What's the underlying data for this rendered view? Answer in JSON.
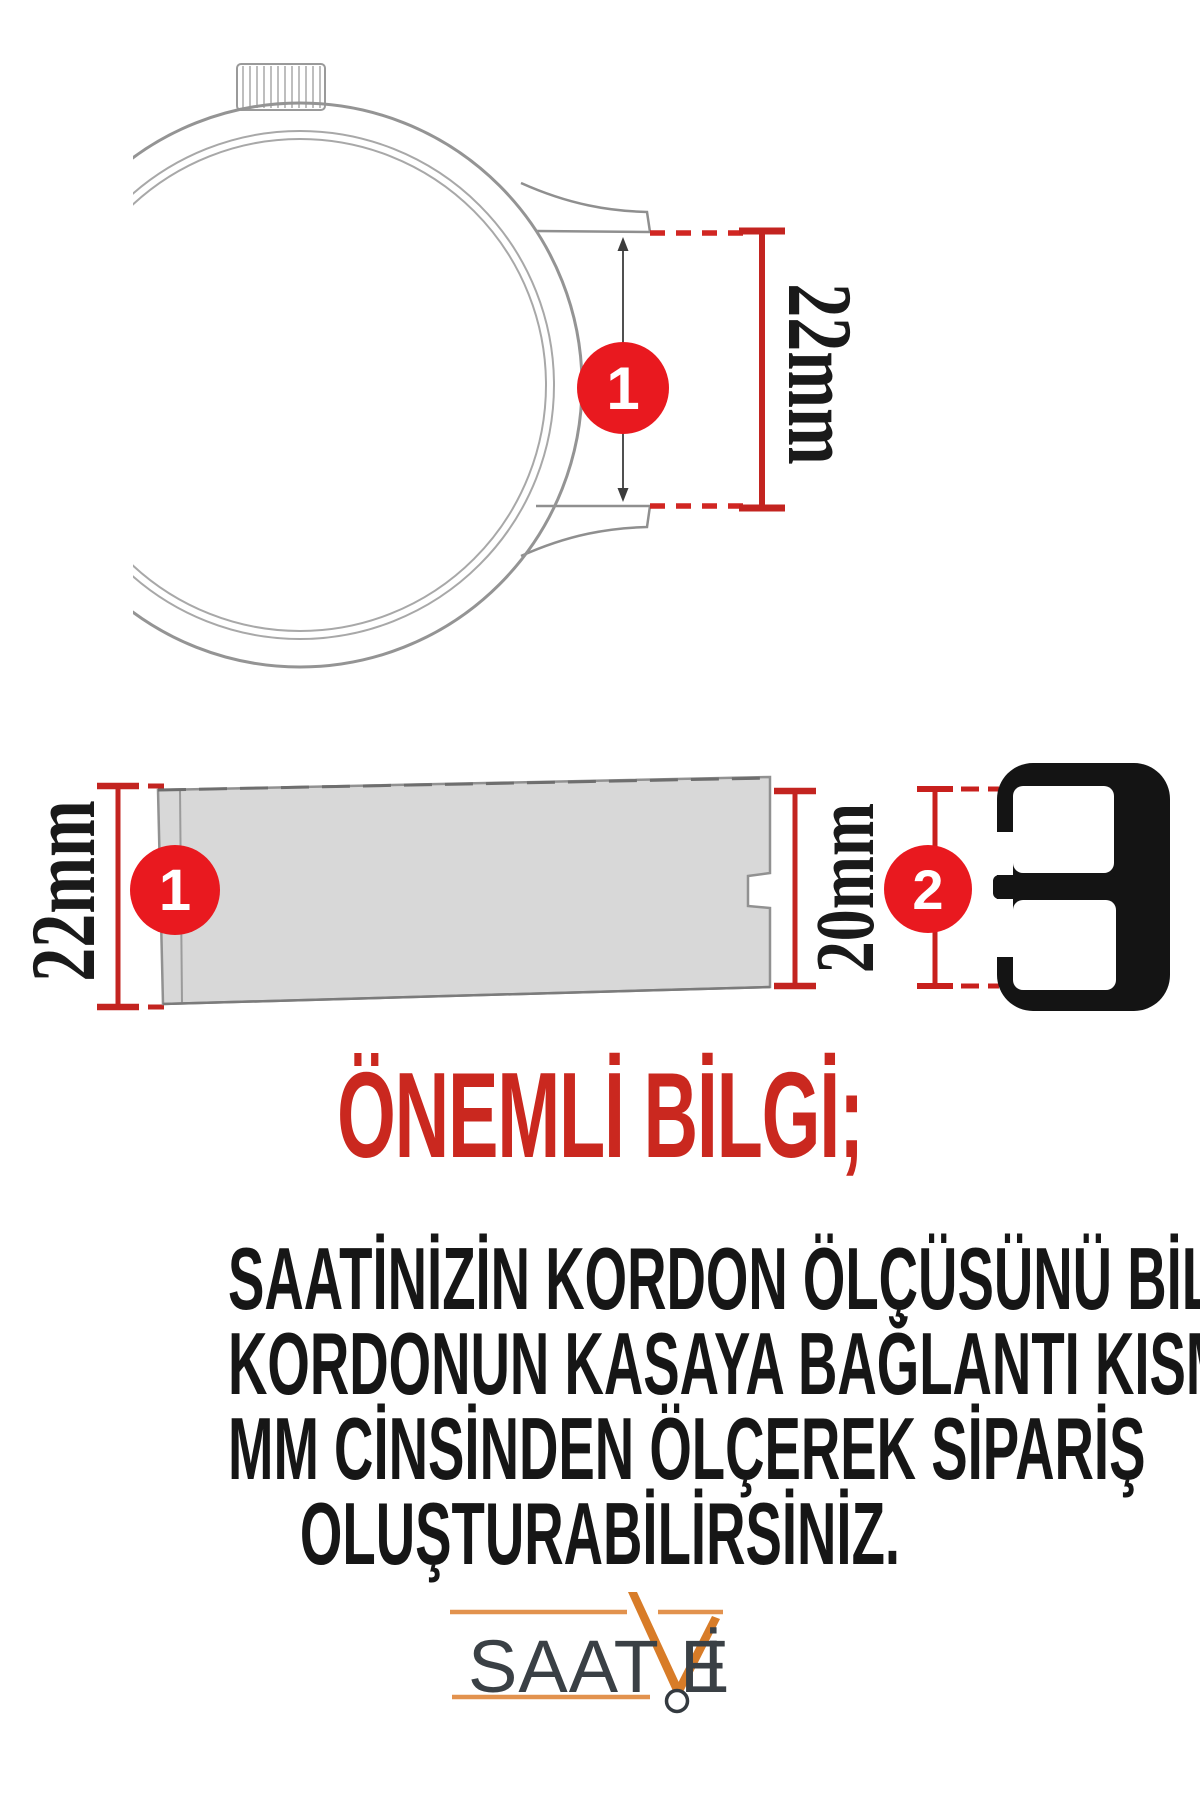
{
  "top_diagram": {
    "marker": "1",
    "width_label": "22mm"
  },
  "strap_diagram": {
    "marker_left": "1",
    "left_width_label": "22mm",
    "marker_right": "2",
    "right_width_label": "20mm"
  },
  "info": {
    "title": "ÖNEMLİ BİLGİ;",
    "lines": [
      "SAATİNİZİN KORDON ÖLÇÜSÜNÜ BİLMİYORSANIZ",
      "KORDONUN KASAYA BAĞLANTI KISMINI CETVEL İLE",
      "MM CİNSİNDEN ÖLÇEREK SİPARİŞ",
      "OLUŞTURABİLİRSİNİZ."
    ]
  },
  "logo": {
    "part1": "SAAT E",
    "part2": "İ"
  },
  "colors": {
    "marker_red": "#e9191f",
    "bar_red": "#c32420",
    "dashed_guide_red": "#d12622",
    "title_red": "#ca281f",
    "body_black": "#161616",
    "strap_gray": "#d8d8d8",
    "outline_gray": "#919191",
    "logo_orange_hands": "#d87c28",
    "logo_orange_lines": "#e2924e",
    "logo_dark": "#3a4045"
  }
}
